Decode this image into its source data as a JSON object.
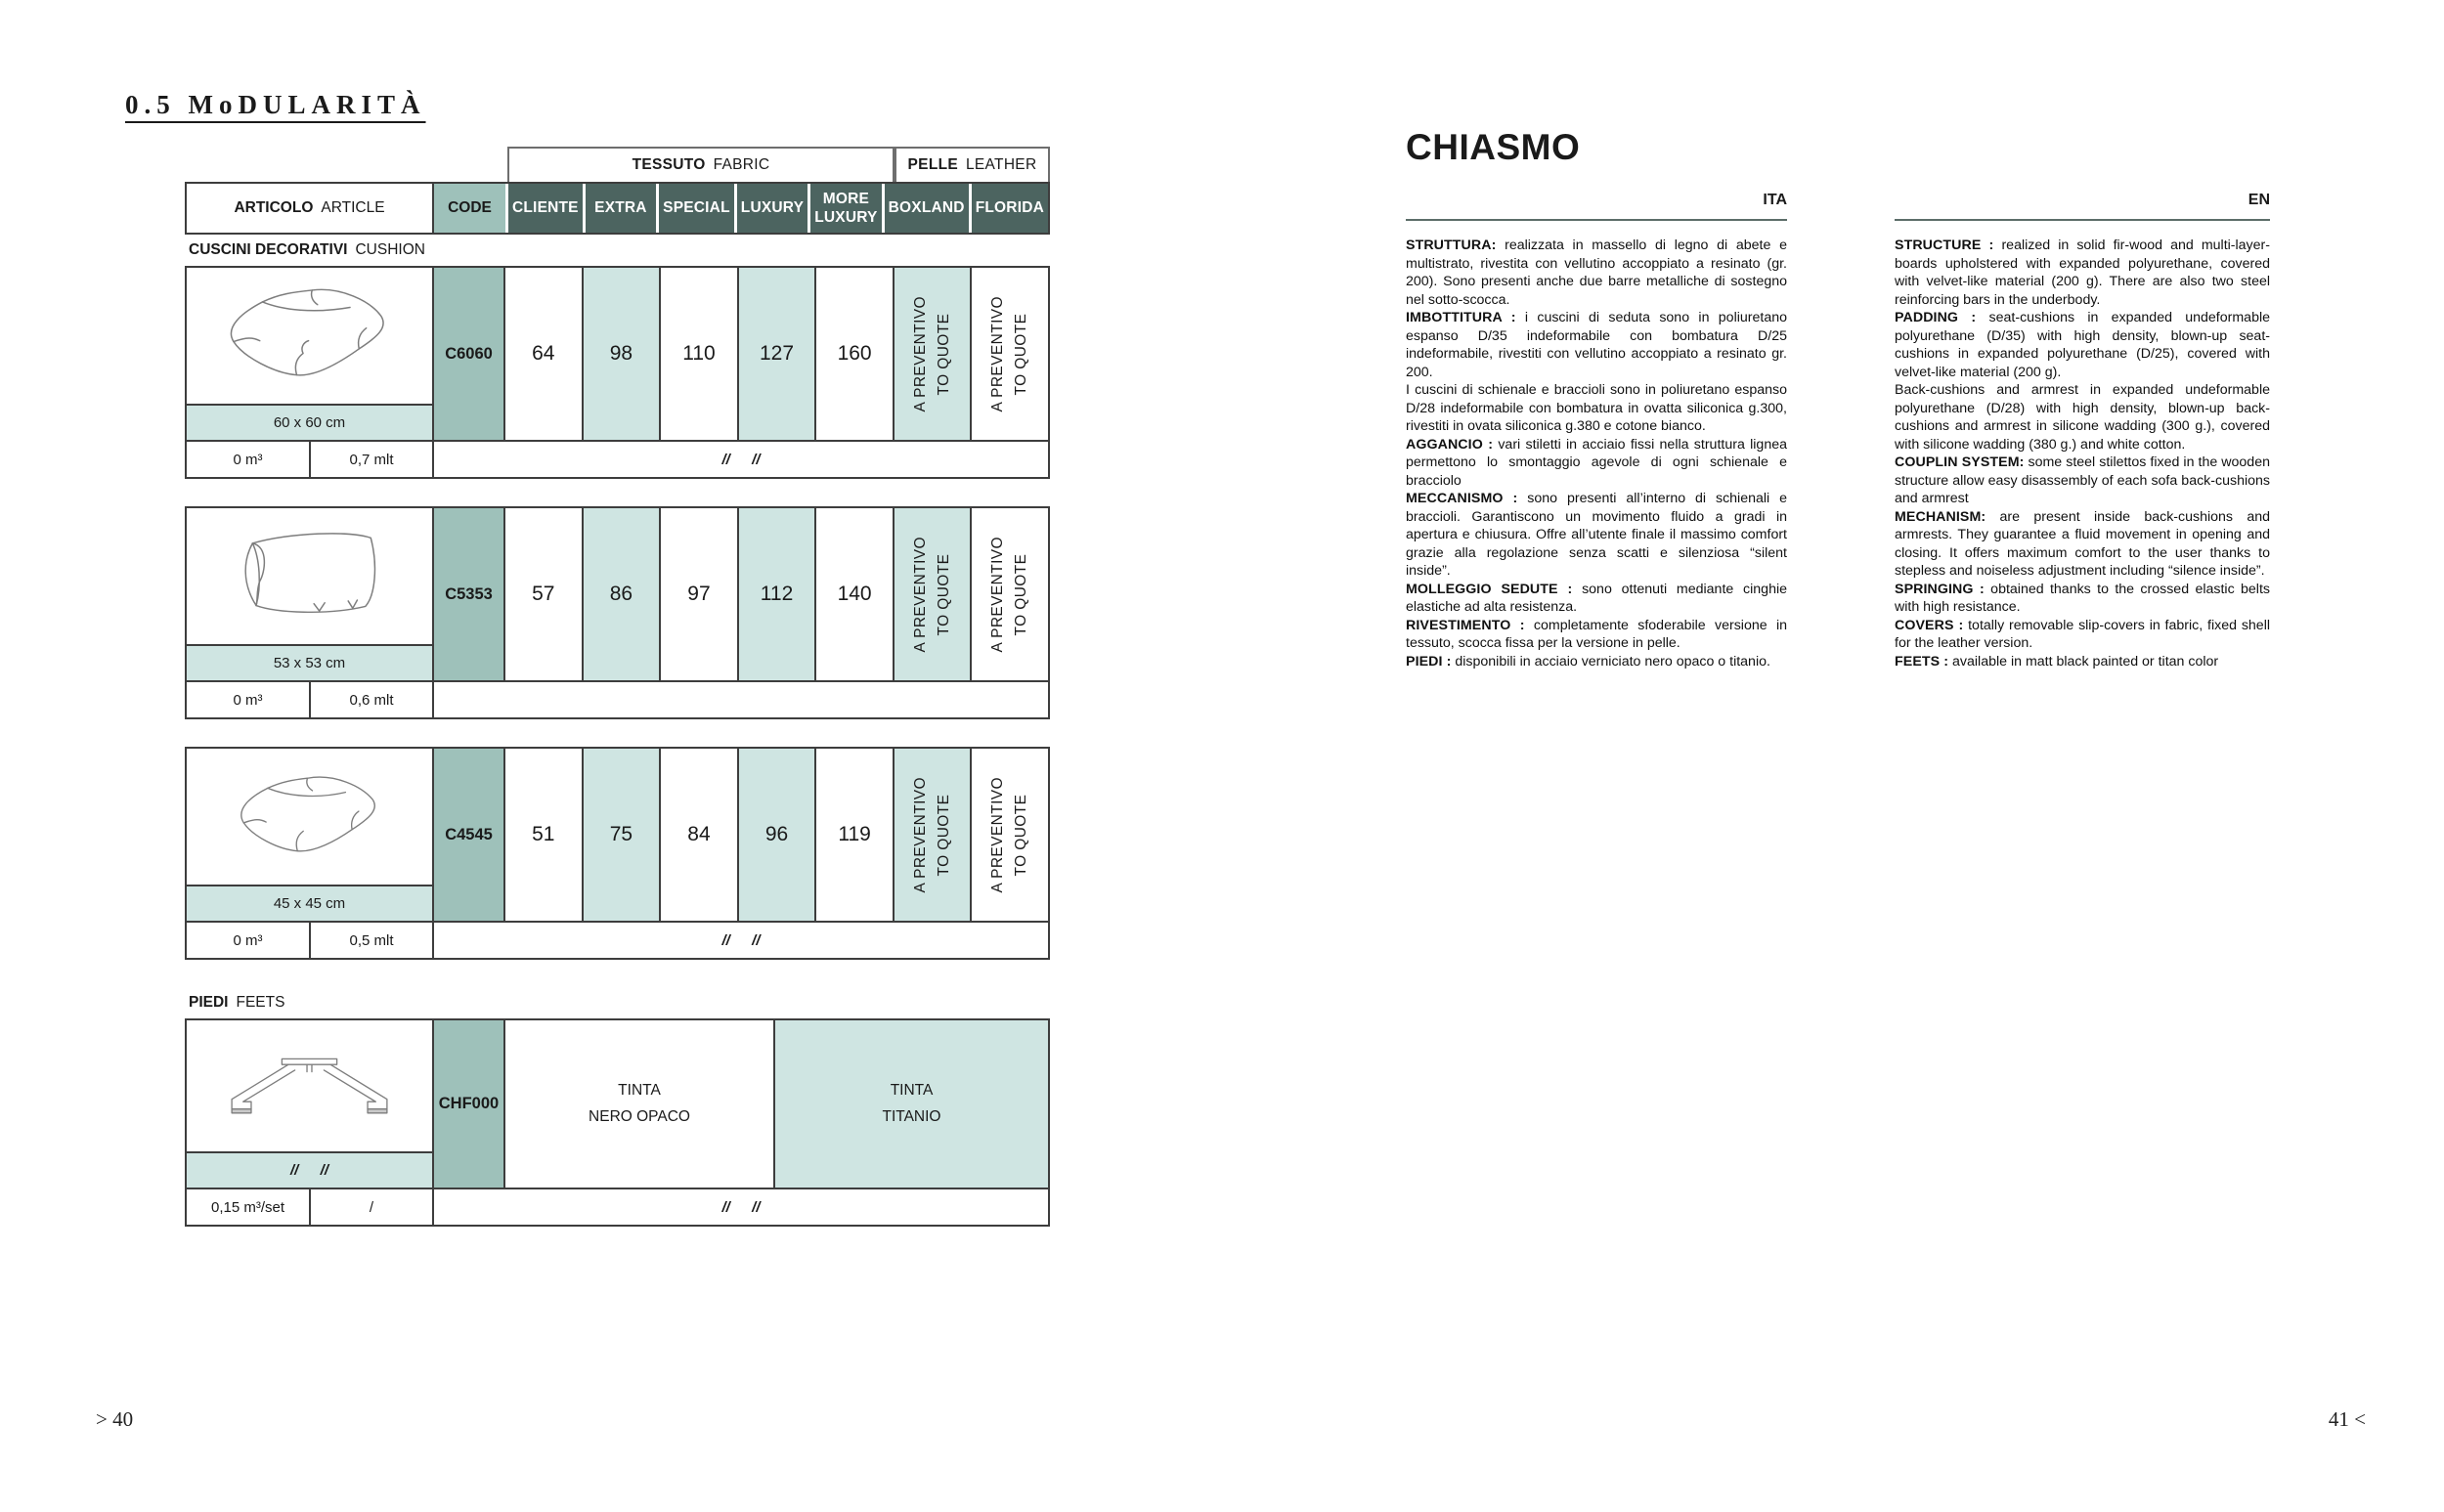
{
  "colors": {
    "dark_header": "#4c6460",
    "code_bg": "#9ec1ba",
    "accent_light": "#cfe5e2",
    "rule": "#5c6d69"
  },
  "left_page": {
    "title": "0.5 MoDULARITÀ",
    "page_number": "> 40",
    "table": {
      "fabric_group": {
        "bold": "TESSUTO",
        "light": "FABRIC"
      },
      "leather_group": {
        "bold": "PELLE",
        "light": "LEATHER"
      },
      "article_header": {
        "bold": "ARTICOLO",
        "light": "ARTICLE"
      },
      "code_header": "CODE",
      "columns": [
        "CLIENTE",
        "EXTRA",
        "SPECIAL",
        "LUXURY",
        "MORE LUXURY",
        "BOXLAND",
        "FLORIDA"
      ],
      "quote_label": "A PREVENTIVO\nTO QUOTE",
      "cushion_section": {
        "bold": "CUSCINI DECORATIVI",
        "light": "CUSHION"
      },
      "feet_section": {
        "bold": "PIEDI",
        "light": "FEETS"
      },
      "rows": [
        {
          "code": "C6060",
          "dimensions": "60 x 60 cm",
          "prices": [
            "64",
            "98",
            "110",
            "127",
            "160"
          ],
          "volume": "0 m³",
          "linear": "0,7 mlt",
          "note": "//  //"
        },
        {
          "code": "C5353",
          "dimensions": "53 x 53 cm",
          "prices": [
            "57",
            "86",
            "97",
            "112",
            "140"
          ],
          "volume": "0 m³",
          "linear": "0,6 mlt",
          "note": ""
        },
        {
          "code": "C4545",
          "dimensions": "45 x 45 cm",
          "prices": [
            "51",
            "75",
            "84",
            "96",
            "119"
          ],
          "volume": "0 m³",
          "linear": "0,5 mlt",
          "note": "//  //"
        }
      ],
      "feet_row": {
        "code": "CHF000",
        "band_note": "//  //",
        "finish_black": "TINTA\nNERO OPACO",
        "finish_titanium": "TINTA\nTITANIO",
        "volume": "0,15 m³/set",
        "linear": "/",
        "note": "//  //"
      }
    }
  },
  "right_page": {
    "product_title": "CHIASMO",
    "ita_label": "ITA",
    "en_label": "EN",
    "page_number": "41 <",
    "ita_paragraphs": [
      {
        "label": "STRUTTURA:",
        "text": " realizzata in massello di legno di abete e multistrato, rivestita con vellutino accoppiato a resinato (gr. 200). Sono presenti anche due barre metalliche di sostegno nel sotto-scocca."
      },
      {
        "label": "IMBOTTITURA :",
        "text": " i cuscini di seduta sono in poliuretano espanso D/35 indeformabile con bombatura D/25 indeformabile, rivestiti con vellutino accoppiato a resinato gr. 200."
      },
      {
        "label": "",
        "text": "I cuscini di schienale e braccioli sono in poliuretano espanso D/28 indeformabile con bombatura in ovatta siliconica g.300, rivestiti in ovata siliconica g.380 e cotone bianco."
      },
      {
        "label": "AGGANCIO :",
        "text": " vari stiletti in acciaio fissi nella struttura lignea permettono lo smontaggio agevole di ogni schienale e bracciolo"
      },
      {
        "label": "MECCANISMO :",
        "text": " sono presenti all’interno di schienali e braccioli. Garantiscono un movimento fluido a gradi in apertura e chiusura. Offre all’utente finale il massimo comfort grazie alla regolazione senza scatti e silenziosa “silent inside”."
      },
      {
        "label": "MOLLEGGIO SEDUTE :",
        "text": " sono ottenuti mediante cinghie elastiche ad alta resistenza."
      },
      {
        "label": "RIVESTIMENTO :",
        "text": " completamente sfoderabile versione in tessuto, scocca fissa per la versione in pelle."
      },
      {
        "label": "PIEDI :",
        "text": " disponibili in acciaio verniciato nero opaco o titanio."
      }
    ],
    "en_paragraphs": [
      {
        "label": "STRUCTURE :",
        "text": " realized in solid fir-wood and multi-layer-boards upholstered with expanded polyurethane, covered with velvet-like material (200 g). There are also two steel reinforcing bars in the underbody."
      },
      {
        "label": "PADDING :",
        "text": " seat-cushions in expanded undeformable polyurethane (D/35) with high density, blown-up seat-cushions in expanded polyurethane (D/25), covered with velvet-like material (200 g)."
      },
      {
        "label": "",
        "text": "Back-cushions and armrest in expanded undeformable polyurethane (D/28) with high density, blown-up back-cushions and armrest in silicone wadding (300 g.), covered with silicone wadding (380 g.) and white cotton."
      },
      {
        "label": "COUPLIN SYSTEM:",
        "text": " some steel stilettos fixed in the wooden structure allow easy disassembly of each sofa back-cushions and armrest"
      },
      {
        "label": "MECHANISM:",
        "text": " are present inside back-cushions and armrests. They guarantee a fluid movement in opening and closing. It offers maximum comfort to the user thanks to stepless and noiseless adjustment including “silence inside”."
      },
      {
        "label": "SPRINGING :",
        "text": " obtained thanks to the crossed elastic belts with high resistance."
      },
      {
        "label": "COVERS :",
        "text": " totally removable slip-covers in fabric, fixed shell for the leather version."
      },
      {
        "label": "FEETS :",
        "text": " available in matt black  painted or titan color"
      }
    ]
  }
}
